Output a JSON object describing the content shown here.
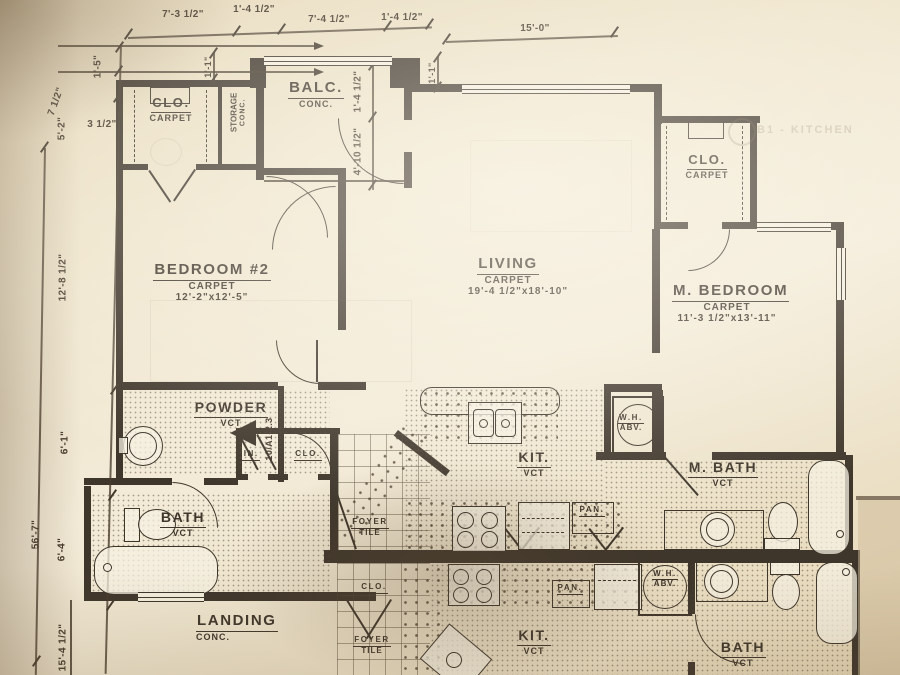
{
  "colors": {
    "paper": "#ece0c6",
    "ink": "#3f362b"
  },
  "rooms": {
    "clo_tl": {
      "name": "CLO.",
      "sub": "CARPET"
    },
    "storage": {
      "name": "STORAGE",
      "sub": "CONC."
    },
    "balc": {
      "name": "BALC.",
      "sub": "CONC."
    },
    "bedroom2": {
      "name": "BEDROOM #2",
      "sub": "CARPET",
      "size": "12'-2\"x12'-5\""
    },
    "living": {
      "name": "LIVING",
      "sub": "CARPET",
      "size": "19'-4 1/2\"x18'-10\""
    },
    "m_bedroom": {
      "name": "M. BEDROOM",
      "sub": "CARPET",
      "size": "11'-3 1/2\"x13'-11\""
    },
    "clo_right": {
      "name": "CLO.",
      "sub": "CARPET"
    },
    "powder": {
      "name": "POWDER",
      "sub": "VCT"
    },
    "lin": {
      "name": "LIN."
    },
    "clo_hall": {
      "name": "CLO."
    },
    "bath1": {
      "name": "BATH",
      "sub": "VCT"
    },
    "foyer1": {
      "name": "FOYER",
      "sub": "TILE"
    },
    "kit1": {
      "name": "KIT.",
      "sub": "VCT"
    },
    "pan1": {
      "name": "PAN."
    },
    "wh1": {
      "name": "W.H.",
      "sub": "ABV."
    },
    "m_bath": {
      "name": "M. BATH",
      "sub": "VCT"
    },
    "landing": {
      "name": "LANDING",
      "sub": "CONC."
    },
    "clo_lower": {
      "name": "CLO."
    },
    "foyer2": {
      "name": "FOYER",
      "sub": "TILE"
    },
    "kit2": {
      "name": "KIT.",
      "sub": "VCT"
    },
    "pan2": {
      "name": "PAN."
    },
    "wh2": {
      "name": "W.H.",
      "sub": "ABV."
    },
    "bath2": {
      "name": "BATH",
      "sub": "VCT"
    }
  },
  "dims": {
    "top": {
      "d1": "7'-3 1/2\"",
      "d2": "1'-4 1/2\"",
      "d3": "7'-4 1/2\"",
      "d4": "1'-4 1/2\"",
      "d5": "15'-0\""
    },
    "left": {
      "d1": "1'-5\"",
      "d2": "7 1/2\"",
      "d3": "5'-2\"",
      "d4": "3 1/2\"",
      "d5": "12'-8 1/2\"",
      "d6": "6'-1\"",
      "d7": "6'-4\"",
      "d8": "56'-7\"",
      "d9": "15'-4 1/2\""
    },
    "balc": {
      "d1": "1'-1\"",
      "d2": "1'-4 1/2\"",
      "d3": "4'-10 1/2\"",
      "d4": "1'-1\""
    }
  },
  "annotations": {
    "section_ref": "10/A1-2.3",
    "watermark": "B1 - KITCHEN"
  }
}
